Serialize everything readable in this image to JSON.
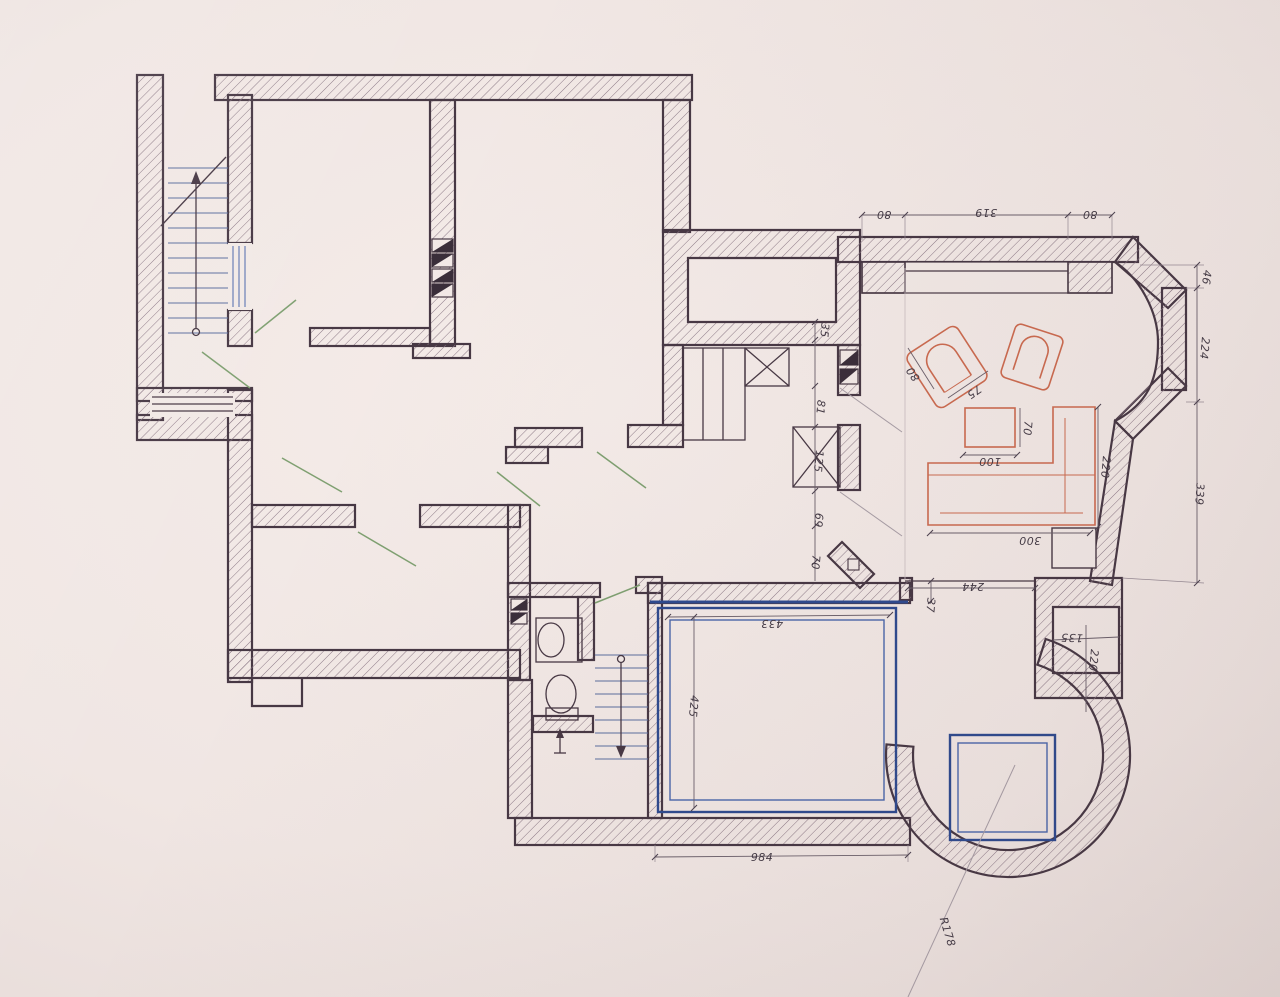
{
  "document": {
    "kind": "hand-drafted floor plan photograph",
    "colors": {
      "paper": "#f0e6e3",
      "ink": "#473844",
      "stairs_blue": "#4a66ab",
      "terrace_navy": "#2e4a8f",
      "furniture_orange": "#cc6b50",
      "door_green": "#7fa071"
    }
  },
  "annotations": {
    "top_window_dims": [
      "80",
      "319",
      "80"
    ],
    "right_bay_dims": [
      "46",
      "224",
      "339"
    ],
    "hall_chain_dims": [
      "35",
      "81",
      "125",
      "69",
      "70"
    ],
    "terrace_dims": {
      "width": "433",
      "height": "425",
      "bottom": "984",
      "step": "37"
    },
    "niche_dims": {
      "offset": "244",
      "width": "135",
      "height": "220"
    },
    "furniture_dims": {
      "armchair": [
        "80",
        "75"
      ],
      "table": [
        "100",
        "70"
      ],
      "sofa": [
        "300",
        "220"
      ]
    },
    "tower_radius": "R178"
  },
  "dimension_labels": [
    {
      "id": "top-left-80",
      "text": "80",
      "x": 884,
      "y": 211,
      "rot": 180
    },
    {
      "id": "top-319",
      "text": "319",
      "x": 986,
      "y": 209,
      "rot": 180
    },
    {
      "id": "top-right-80",
      "text": "80",
      "x": 1090,
      "y": 211,
      "rot": 180
    },
    {
      "id": "right-46",
      "text": "46",
      "x": 1203,
      "y": 277,
      "rot": 97
    },
    {
      "id": "right-224",
      "text": "224",
      "x": 1201,
      "y": 348,
      "rot": 95
    },
    {
      "id": "right-339",
      "text": "339",
      "x": 1196,
      "y": 494,
      "rot": 93
    },
    {
      "id": "chain-35",
      "text": "35",
      "x": 821,
      "y": 330,
      "rot": 95
    },
    {
      "id": "chain-81",
      "text": "81",
      "x": 817,
      "y": 407,
      "rot": 95
    },
    {
      "id": "chain-125",
      "text": "125",
      "x": 815,
      "y": 461,
      "rot": 95
    },
    {
      "id": "chain-69",
      "text": "69",
      "x": 815,
      "y": 520,
      "rot": 95
    },
    {
      "id": "chain-70",
      "text": "70",
      "x": 812,
      "y": 562,
      "rot": 95
    },
    {
      "id": "step-37",
      "text": "37",
      "x": 927,
      "y": 605,
      "rot": 95
    },
    {
      "id": "offset-244",
      "text": "244",
      "x": 973,
      "y": 583,
      "rot": 180
    },
    {
      "id": "niche-135",
      "text": "135",
      "x": 1072,
      "y": 634,
      "rot": 182
    },
    {
      "id": "niche-220",
      "text": "220",
      "x": 1090,
      "y": 660,
      "rot": 95
    },
    {
      "id": "armchair-80",
      "text": "80",
      "x": 916,
      "y": 372,
      "rot": -125
    },
    {
      "id": "armchair-75",
      "text": "75",
      "x": 972,
      "y": 389,
      "rot": 145
    },
    {
      "id": "table-70",
      "text": "70",
      "x": 1024,
      "y": 428,
      "rot": 95
    },
    {
      "id": "table-100",
      "text": "100",
      "x": 990,
      "y": 458,
      "rot": 180
    },
    {
      "id": "sofa-220",
      "text": "220",
      "x": 1102,
      "y": 467,
      "rot": 95
    },
    {
      "id": "sofa-300",
      "text": "300",
      "x": 1030,
      "y": 537,
      "rot": 180
    },
    {
      "id": "terrace-433",
      "text": "433",
      "x": 772,
      "y": 620,
      "rot": 180
    },
    {
      "id": "terrace-425",
      "text": "425",
      "x": 690,
      "y": 706,
      "rot": 95
    },
    {
      "id": "bottom-984",
      "text": "984",
      "x": 762,
      "y": 861,
      "rot": 0
    },
    {
      "id": "radius",
      "text": "R178",
      "x": 944,
      "y": 933,
      "rot": 73
    }
  ]
}
